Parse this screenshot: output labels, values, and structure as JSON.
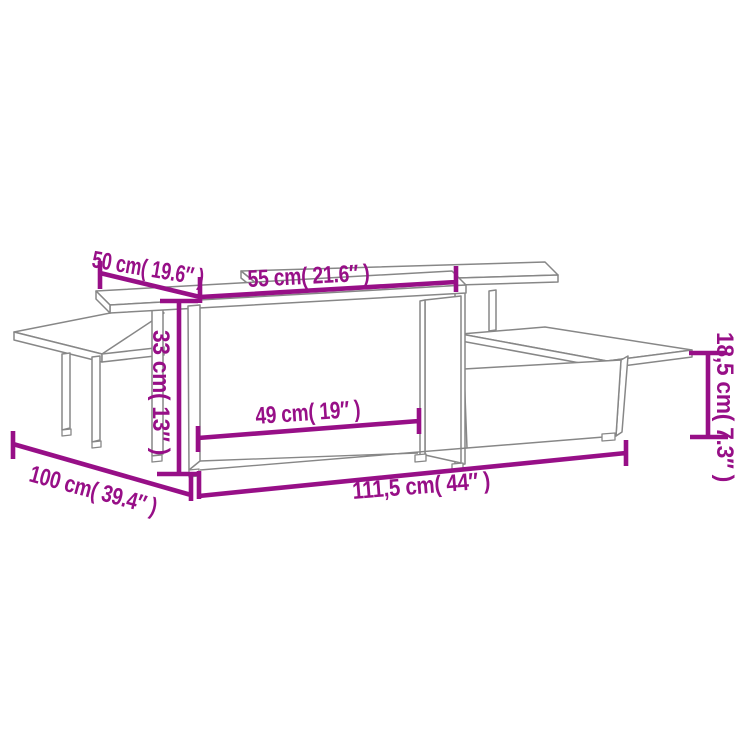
{
  "diagram": {
    "title": "coffee-table-set-dimension-diagram",
    "background_color": "#ffffff",
    "wireframe_color": "#878787",
    "dimension_color": "#970f87",
    "dimensions": [
      {
        "name": "small-table-depth",
        "cm": "50",
        "inch": "19.6",
        "label": "50 cm( 19.6″ )"
      },
      {
        "name": "large-table-depth",
        "cm": "55",
        "inch": "21.6",
        "label": "55 cm( 21.6″ )"
      },
      {
        "name": "tall-section-height",
        "cm": "33",
        "inch": "13",
        "label": "33 cm( 13″ )"
      },
      {
        "name": "inner-opening-width",
        "cm": "49",
        "inch": "19",
        "label": "49 cm( 19″ )"
      },
      {
        "name": "low-section-height",
        "cm": "18,5",
        "inch": "7.3",
        "label": "18,5 cm( 7.3″ )"
      },
      {
        "name": "small-table-width",
        "cm": "100",
        "inch": "39.4",
        "label": "100 cm( 39.4″ )"
      },
      {
        "name": "large-table-width",
        "cm": "111,5",
        "inch": "44",
        "label": "111,5 cm( 44″ )"
      }
    ]
  }
}
